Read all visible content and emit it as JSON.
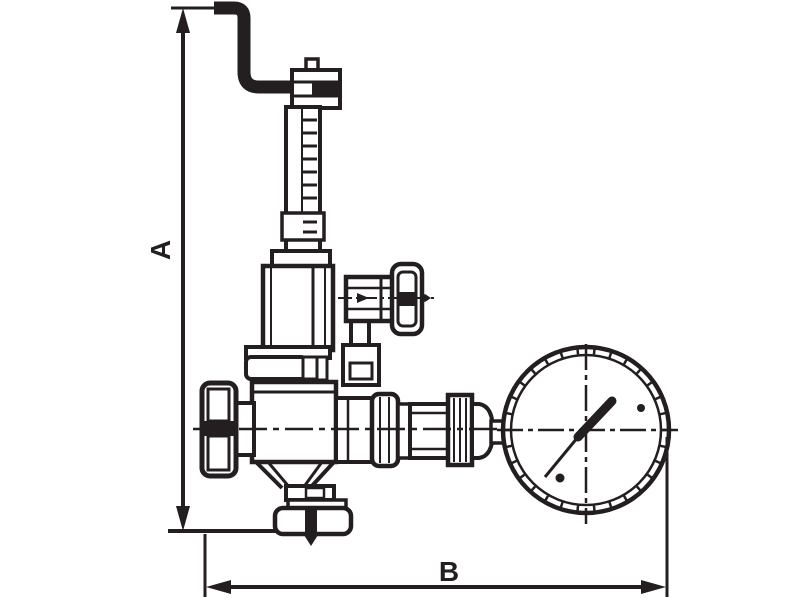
{
  "colors": {
    "line": "#231f20",
    "background": "#ffffff"
  },
  "dimensions": {
    "vertical": {
      "label": "A"
    },
    "horizontal": {
      "label": "B"
    }
  },
  "components": {
    "top": "overflow-pipe",
    "stem": "threaded-adjustment-stem",
    "bonnet": "spring-bonnet",
    "side": "side-test-cock",
    "body": "valve-body",
    "inlet": "inlet-union-nut",
    "train": "gauge-connection-union",
    "gauge": "pressure-gauge",
    "bottom": "bottom-outlet-flange"
  }
}
